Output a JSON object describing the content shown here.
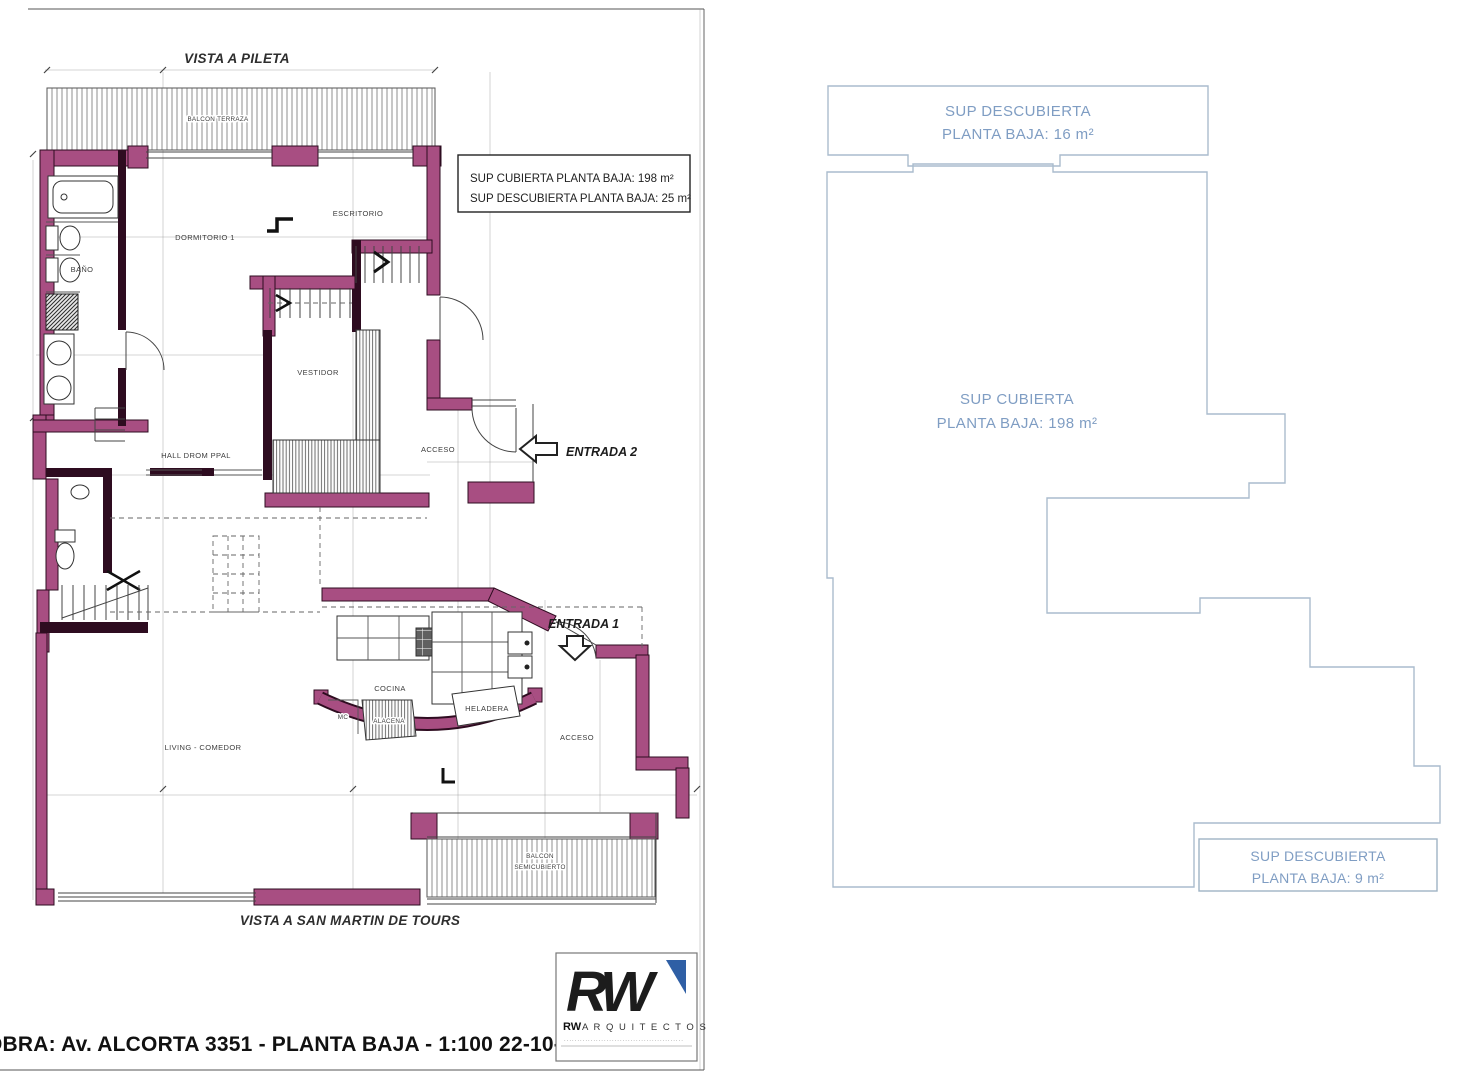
{
  "left": {
    "title_top": "VISTA A PILETA",
    "title_bottom": "VISTA A SAN MARTIN DE TOURS",
    "obra": "OBRA: Av. ALCORTA 3351 - PLANTA BAJA - 1:100 22-10-2019",
    "info_box": {
      "line1": "SUP CUBIERTA PLANTA BAJA: 198 m²",
      "line2": "SUP DESCUBIERTA PLANTA BAJA: 25 m²"
    },
    "rooms": {
      "balcon_terraza": "BALCON TERRAZA",
      "dormitorio": "DORMITORIO 1",
      "escritorio": "ESCRITORIO",
      "bano": "BAÑO",
      "vestidor": "VESTIDOR",
      "hall": "HALL DROM PPAL",
      "acceso_2": "ACCESO",
      "cocina": "COCINA",
      "mc": "MC",
      "alacena": "ALACENA",
      "heladera": "HELADERA",
      "acceso_1": "ACCESO",
      "living": "LIVING - COMEDOR",
      "balcon_semi_l1": "BALCON",
      "balcon_semi_l2": "SEMICUBIERTO"
    },
    "entradas": {
      "e1": "ENTRADA 1",
      "e2": "ENTRADA 2"
    },
    "logo": {
      "monogram": "RW",
      "brand_bold": "RW",
      "brand_rest": "A R Q U I T E C T O S",
      "tagline": "·············································"
    }
  },
  "right": {
    "area_16": {
      "l1": "SUP DESCUBIERTA",
      "l2": "PLANTA BAJA: 16 m²"
    },
    "area_198": {
      "l1": "SUP CUBIERTA",
      "l2": "PLANTA BAJA: 198 m²"
    },
    "area_9": {
      "l1": "SUP DESCUBIERTA",
      "l2": "PLANTA BAJA: 9 m²"
    }
  },
  "colors": {
    "wall_fill": "#a84e82",
    "wall_edge": "#2e0c20",
    "blue_line": "#aabccd",
    "blue_text": "#7f9dc3",
    "logo_accent": "#2f5fa5",
    "line": "#444444"
  }
}
